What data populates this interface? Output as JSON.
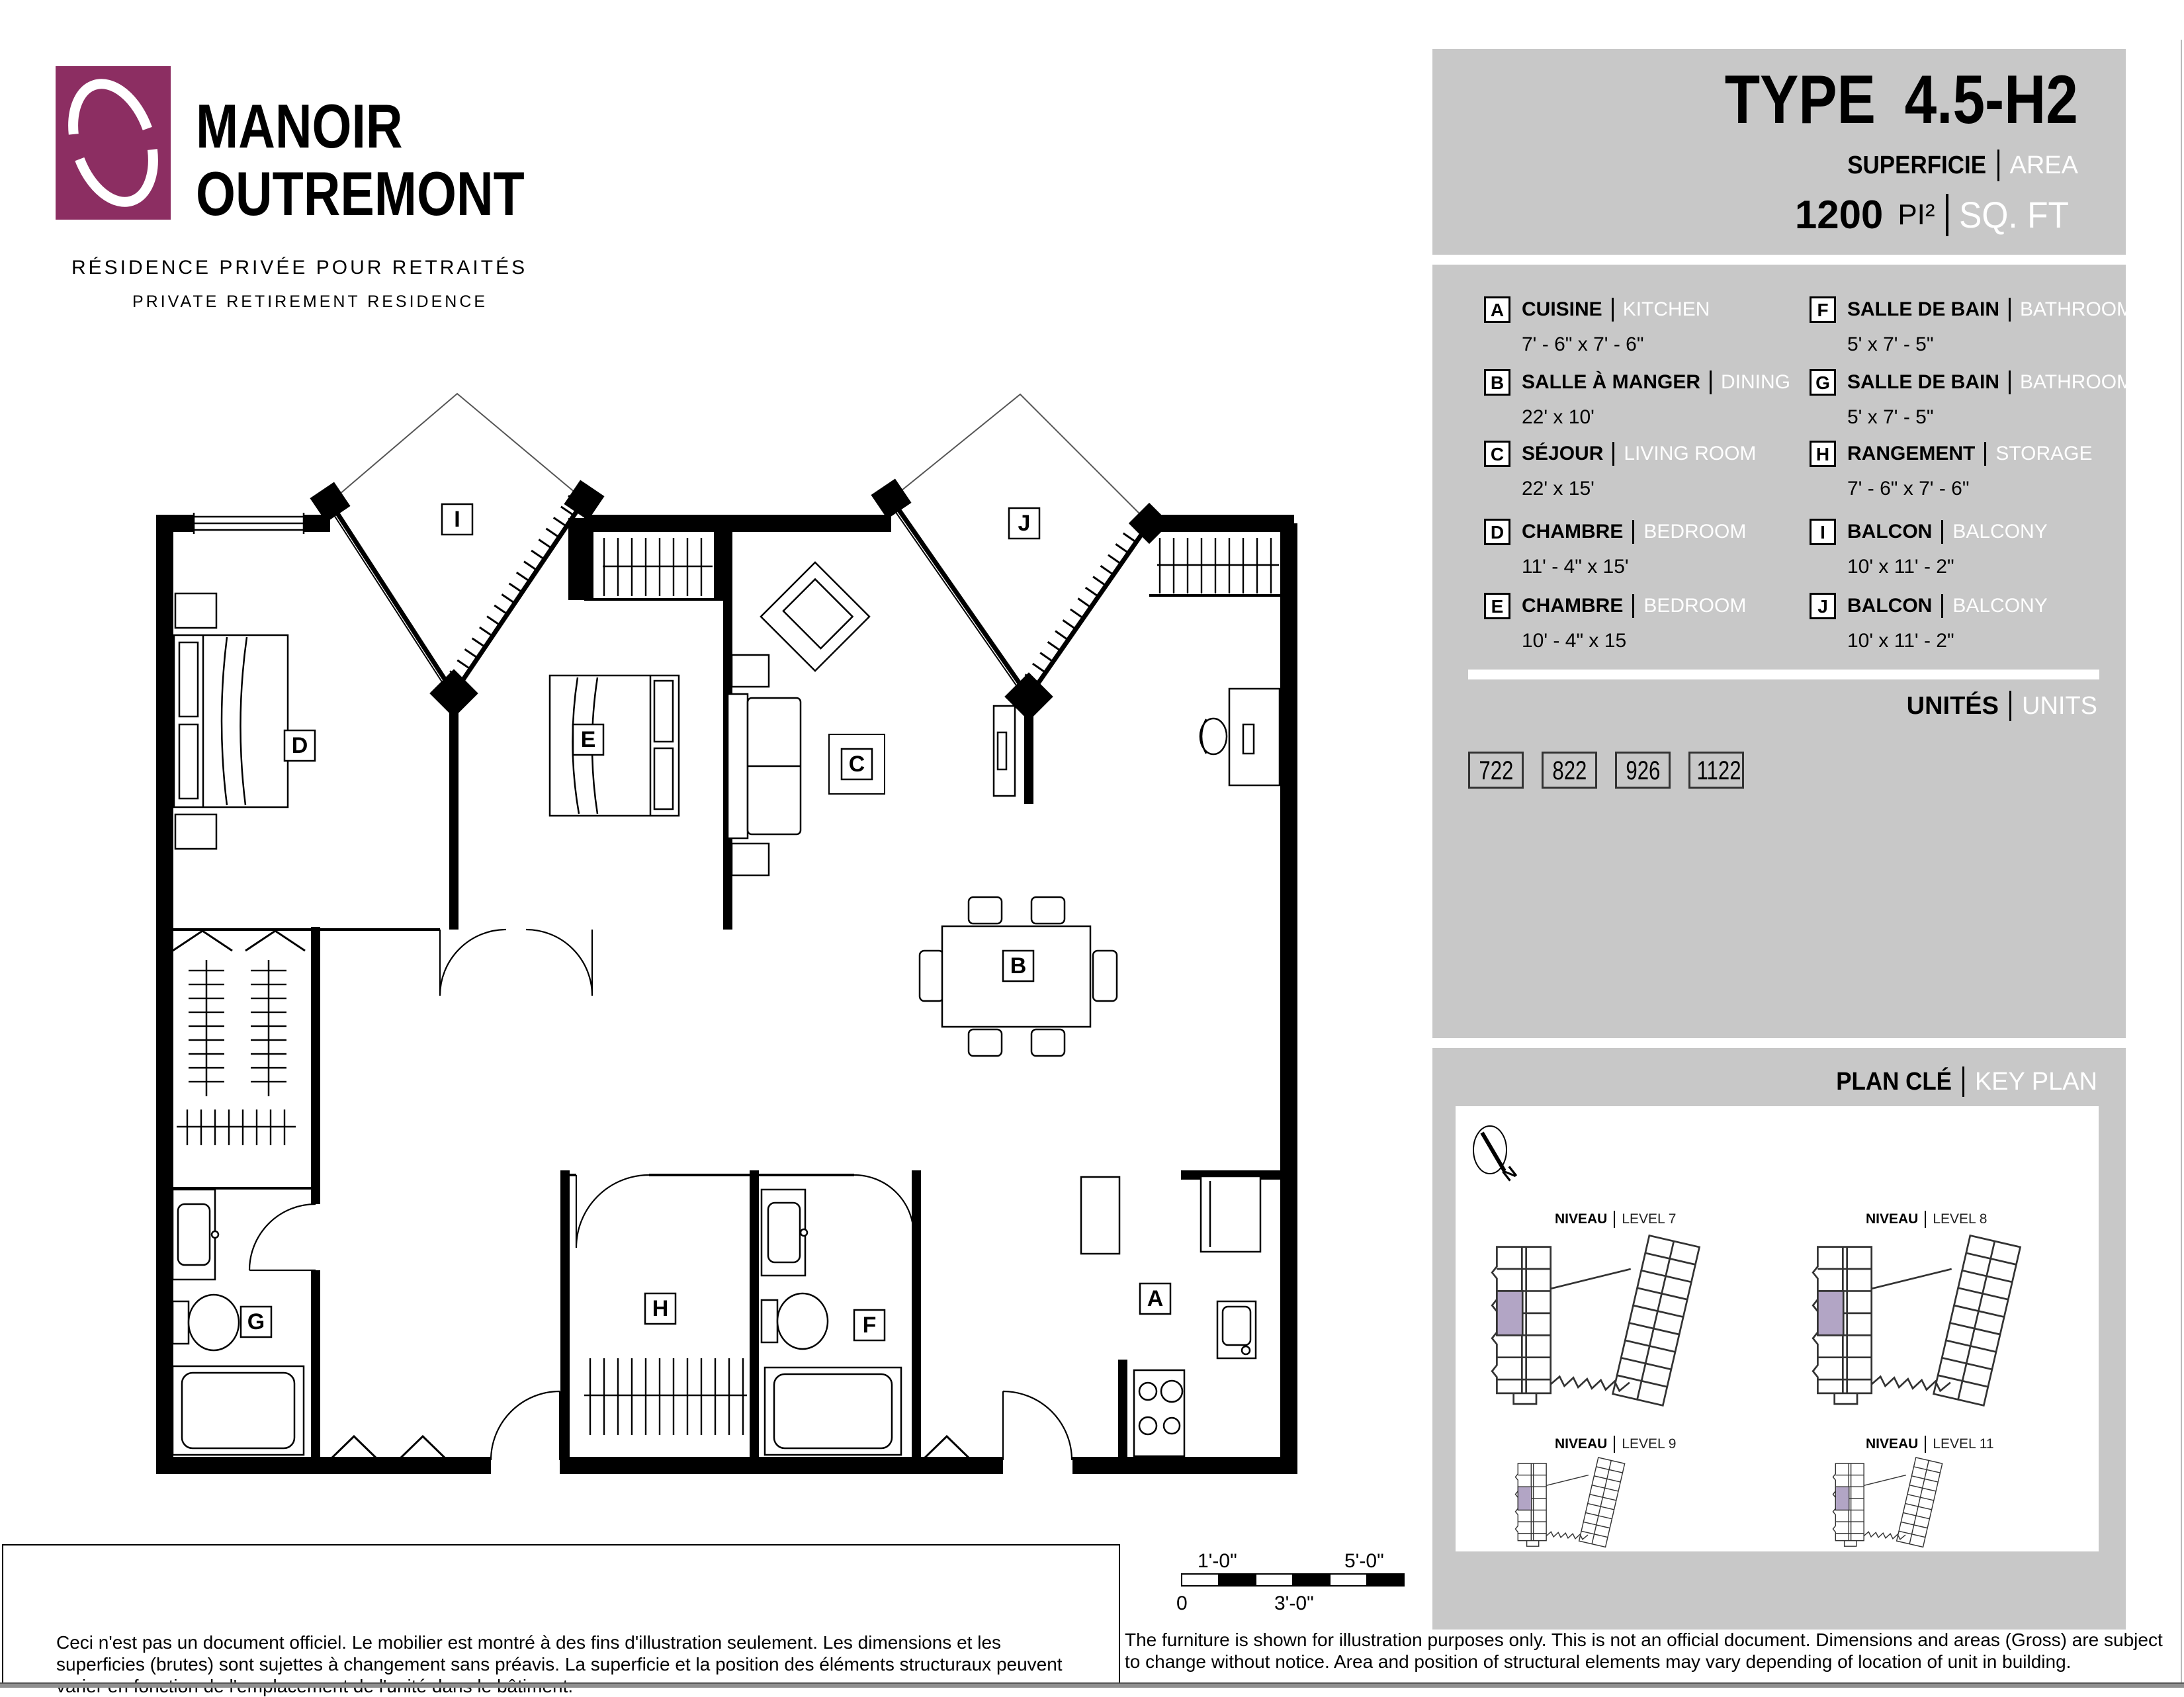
{
  "colors": {
    "panel_gray": "#c8c8c8",
    "logo_plum": "#8c2e62",
    "keyplan_highlight": "#b2a5c5",
    "footer_bar": "#8f8f8f"
  },
  "logo": {
    "line1": "MANOIR",
    "line2": "OUTREMONT",
    "tagline_fr": "RÉSIDENCE PRIVÉE POUR RETRAITÉS",
    "tagline_en": "PRIVATE RETIREMENT RESIDENCE"
  },
  "header": {
    "type_label": "TYPE",
    "type_value": "4.5-H2",
    "sup_fr": "SUPERFICIE",
    "sup_en": "AREA",
    "area_value": "1200",
    "area_unit_fr": "PI²",
    "area_unit_en": "SQ. FT"
  },
  "legend": {
    "left": [
      {
        "letter": "A",
        "fr": "CUISINE",
        "en": "KITCHEN",
        "dims": "7' - 6\" x 7' - 6\""
      },
      {
        "letter": "B",
        "fr": "SALLE À MANGER",
        "en": "DINING",
        "dims": "22' x 10'"
      },
      {
        "letter": "C",
        "fr": "SÉJOUR",
        "en": "LIVING ROOM",
        "dims": "22' x 15'"
      },
      {
        "letter": "D",
        "fr": "CHAMBRE",
        "en": "BEDROOM",
        "dims": "11' - 4\" x 15'"
      },
      {
        "letter": "E",
        "fr": "CHAMBRE",
        "en": "BEDROOM",
        "dims": "10' - 4\" x 15"
      }
    ],
    "right": [
      {
        "letter": "F",
        "fr": "SALLE DE BAIN",
        "en": "BATHROOM",
        "dims": "5' x 7' - 5\""
      },
      {
        "letter": "G",
        "fr": "SALLE DE BAIN",
        "en": "BATHROOM",
        "dims": "5' x 7' - 5\""
      },
      {
        "letter": "H",
        "fr": "RANGEMENT",
        "en": "STORAGE",
        "dims": "7' - 6\" x 7' - 6\""
      },
      {
        "letter": "I",
        "fr": "BALCON",
        "en": "BALCONY",
        "dims": "10' x 11' - 2\""
      },
      {
        "letter": "J",
        "fr": "BALCON",
        "en": "BALCONY",
        "dims": "10' x 11' - 2\""
      }
    ]
  },
  "units": {
    "label_fr": "UNITÉS",
    "label_en": "UNITS",
    "numbers": [
      "722",
      "822",
      "926",
      "1122"
    ]
  },
  "keyplan": {
    "title_fr": "PLAN CLÉ",
    "title_en": "KEY PLAN",
    "levels": [
      {
        "niveau": "NIVEAU",
        "level": "LEVEL 7"
      },
      {
        "niveau": "NIVEAU",
        "level": "LEVEL 8"
      },
      {
        "niveau": "NIVEAU",
        "level": "LEVEL 9"
      },
      {
        "niveau": "NIVEAU",
        "level": "LEVEL 11"
      }
    ]
  },
  "plan": {
    "labels": [
      "A",
      "B",
      "C",
      "D",
      "E",
      "F",
      "G",
      "H",
      "I",
      "J"
    ]
  },
  "scalebar": {
    "t1": "1'-0\"",
    "t2": "5'-0\"",
    "b1": "0",
    "b2": "3'-0\""
  },
  "footer": {
    "fr": "Ceci n'est pas un document officiel.  Le mobilier est montré à des fins d'illustration seulement.  Les dimensions et les superficies (brutes) sont sujettes à changement sans préavis. La superficie et la position des éléments structuraux peuvent varier en fonction de l'emplacement de l'unité dans le bâtiment.",
    "en": "The furniture is shown for illustration purposes only.  This is not an official document.  Dimensions and areas (Gross) are subject to change without notice. Area and position of structural elements may vary depending of location of unit in building."
  }
}
